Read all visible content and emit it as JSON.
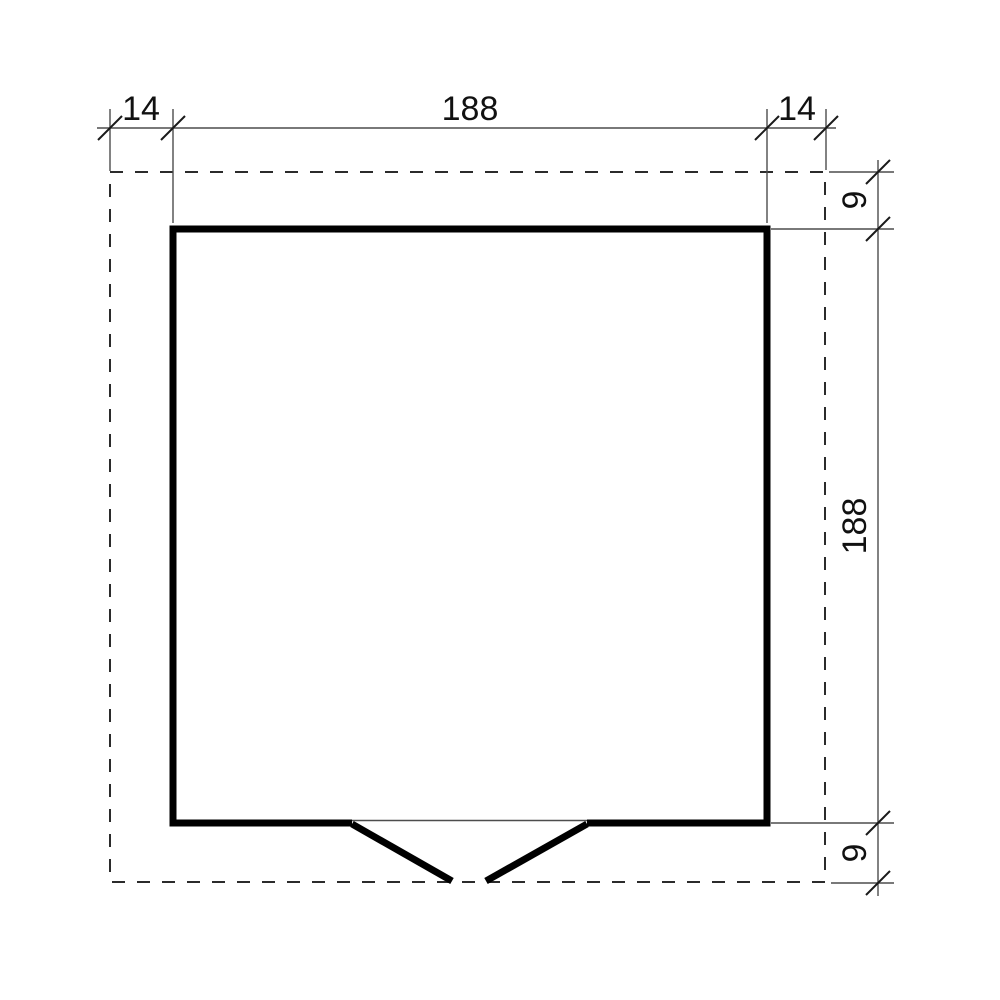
{
  "drawing": {
    "kind": "floor-plan-dimension-drawing",
    "colors": {
      "background": "#ffffff",
      "wall": "#000000",
      "thin_line": "#4d4d4d",
      "dashed_line": "#2b2b2b",
      "tick": "#1a1a1a",
      "text": "#111111"
    },
    "dimensions": {
      "top": {
        "left": "14",
        "middle": "188",
        "right": "14"
      },
      "right": {
        "top": "9",
        "middle": "188",
        "bottom": "9"
      }
    }
  }
}
